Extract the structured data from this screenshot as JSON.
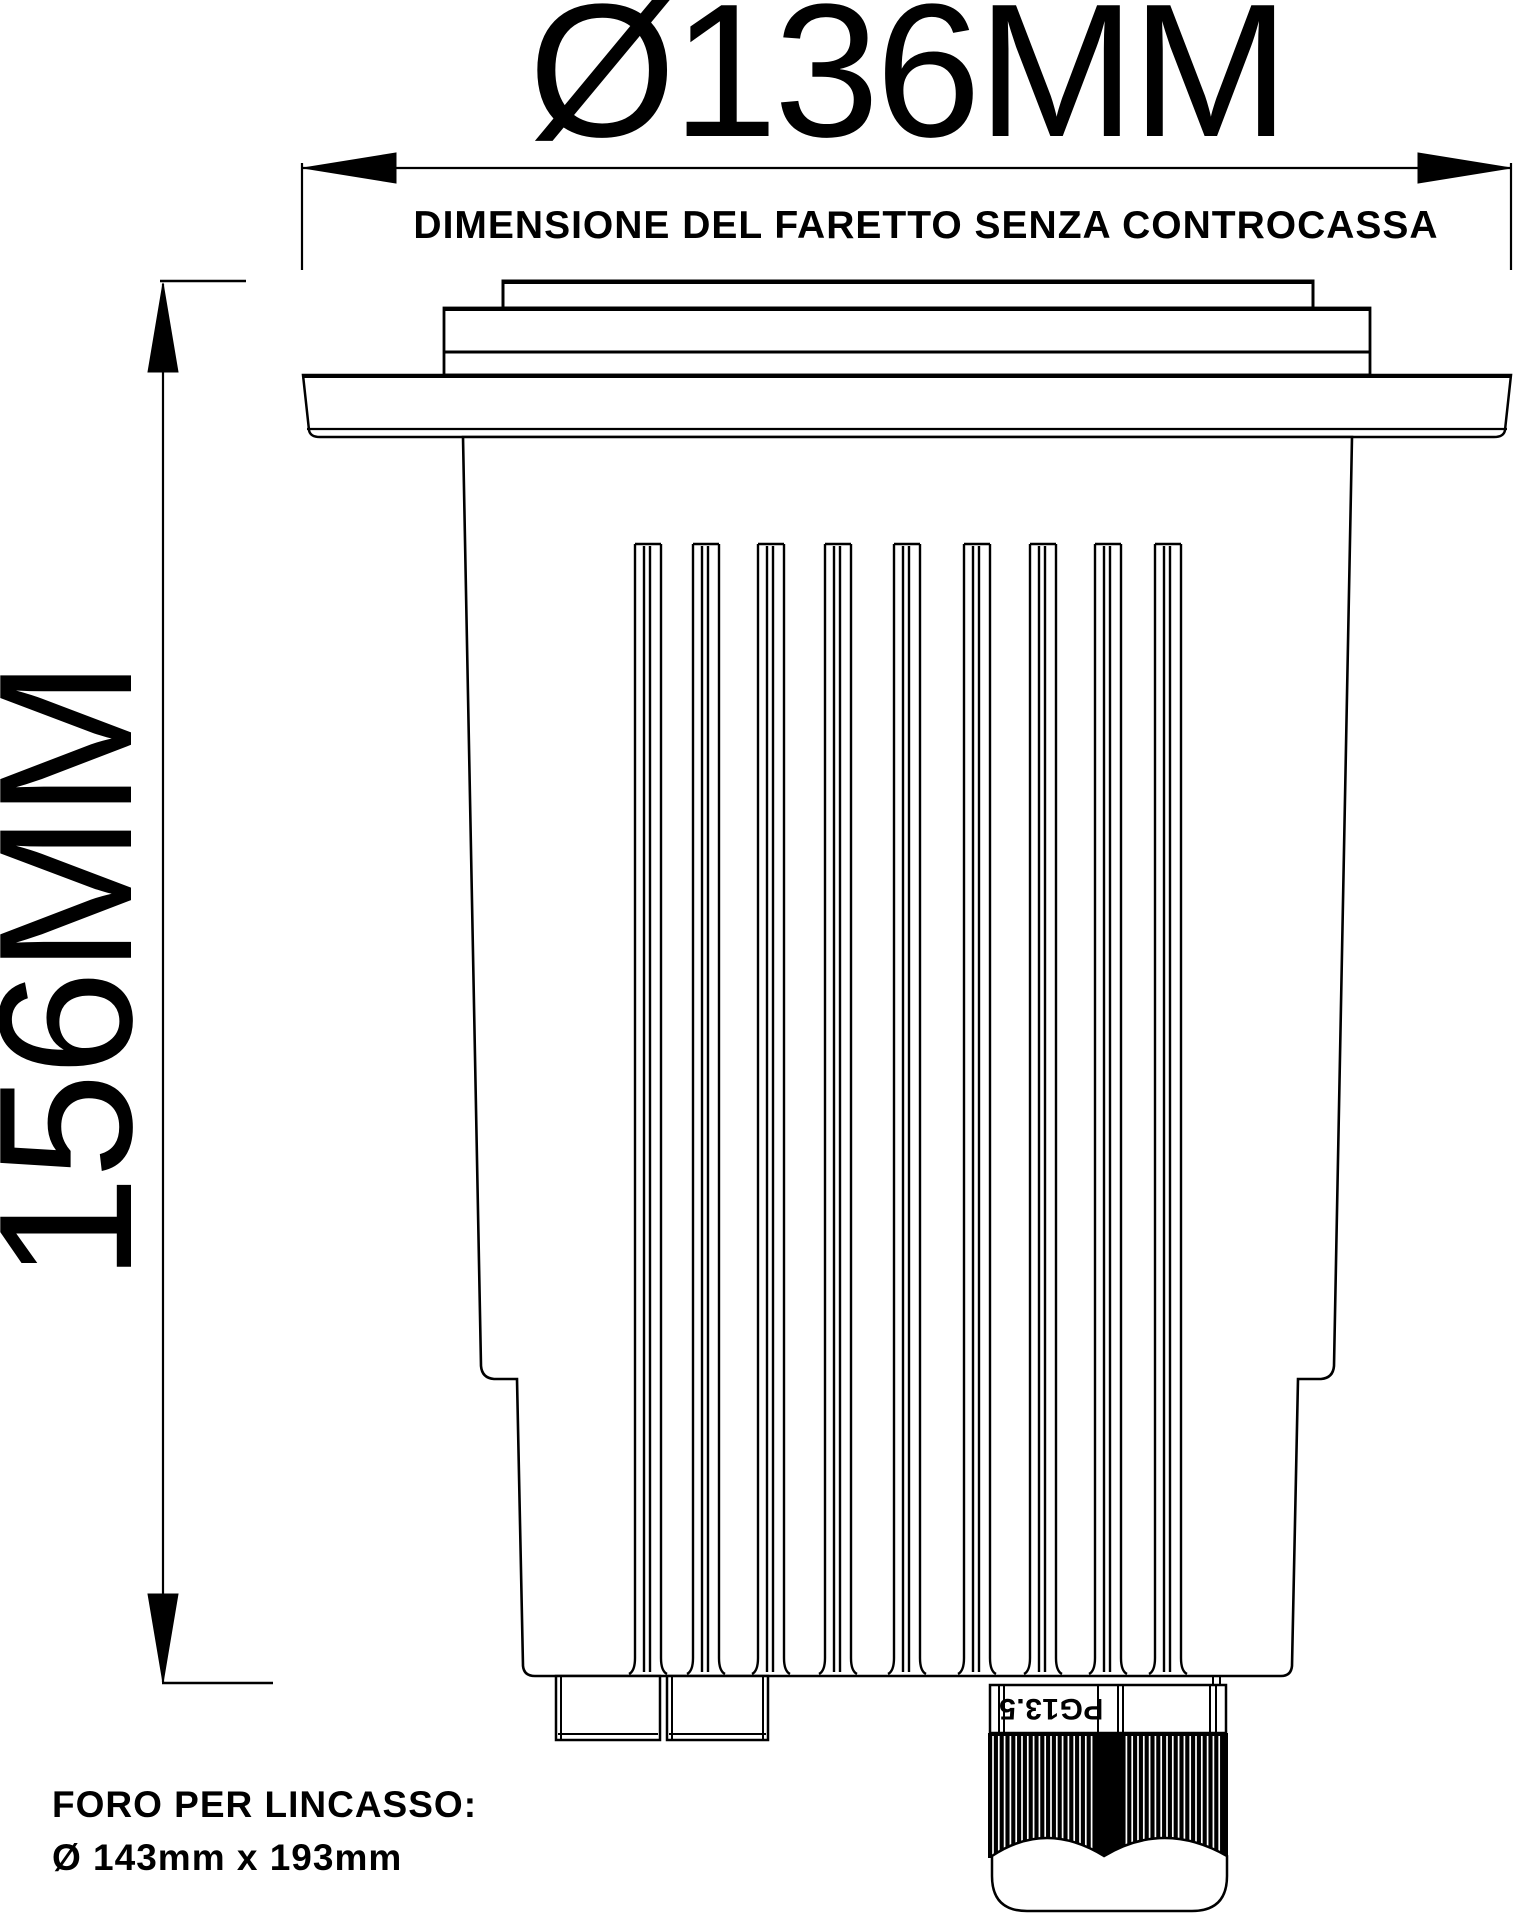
{
  "drawing": {
    "diameter_dimension": "Ø136MM",
    "diameter_caption": "DIMENSIONE DEL FARETTO SENZA CONTROCASSA",
    "height_dimension": "156MM",
    "recess_note_line1": "FORO PER LINCASSO:",
    "recess_note_line2": "Ø 143mm x 193mm",
    "gland_marking": "PG13.5",
    "colors": {
      "ink": "#000000",
      "paper": "#ffffff"
    }
  }
}
